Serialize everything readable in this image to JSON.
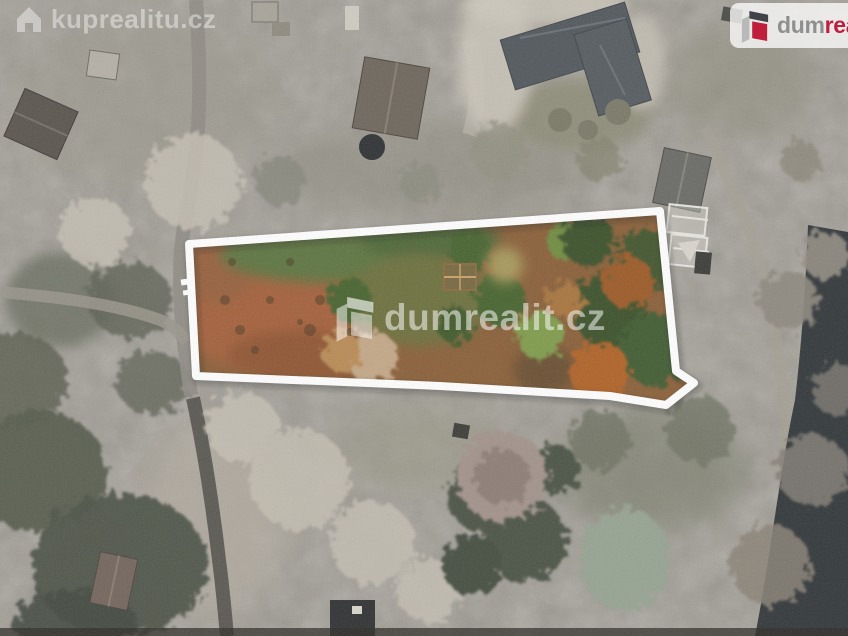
{
  "watermarks": {
    "topleft": {
      "text": "kuprealitu.cz",
      "icon": "house-icon"
    },
    "center": {
      "text": "dumrealit.cz",
      "icon": "building-icon"
    },
    "logo": {
      "text_gray": "dum",
      "text_red": "real",
      "icon": "building-icon"
    }
  },
  "colors": {
    "logo_gray": "#8f8f8f",
    "logo_red": "#bf1e3e",
    "plot_outline": "#ffffff",
    "watermark_white": "rgba(255,255,255,0.45)"
  }
}
